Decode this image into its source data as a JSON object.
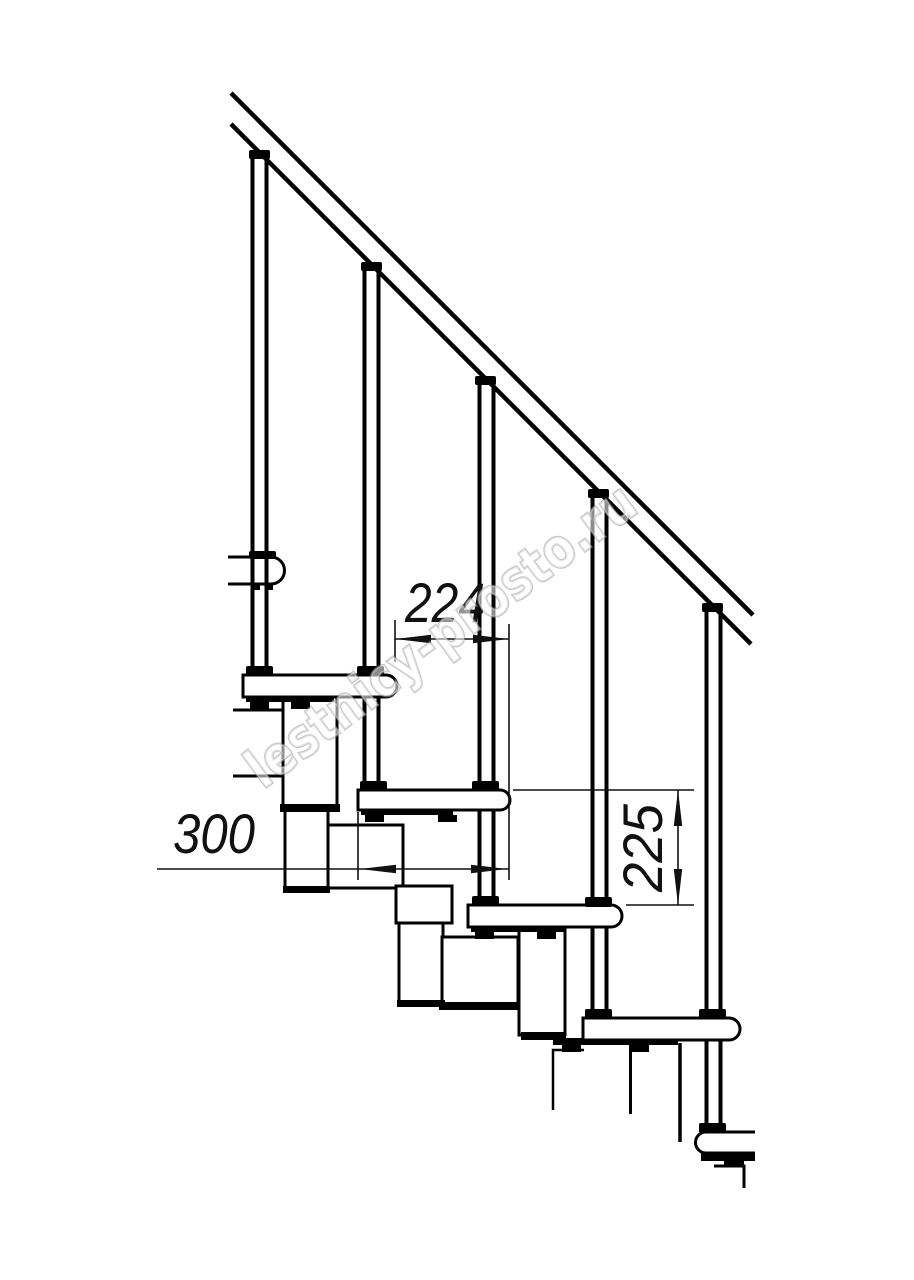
{
  "drawing": {
    "watermark": "lestnicy-prosto.ru",
    "dimensions": {
      "tread_depth": "224",
      "tread_length": "300",
      "rise_height": "225"
    }
  }
}
